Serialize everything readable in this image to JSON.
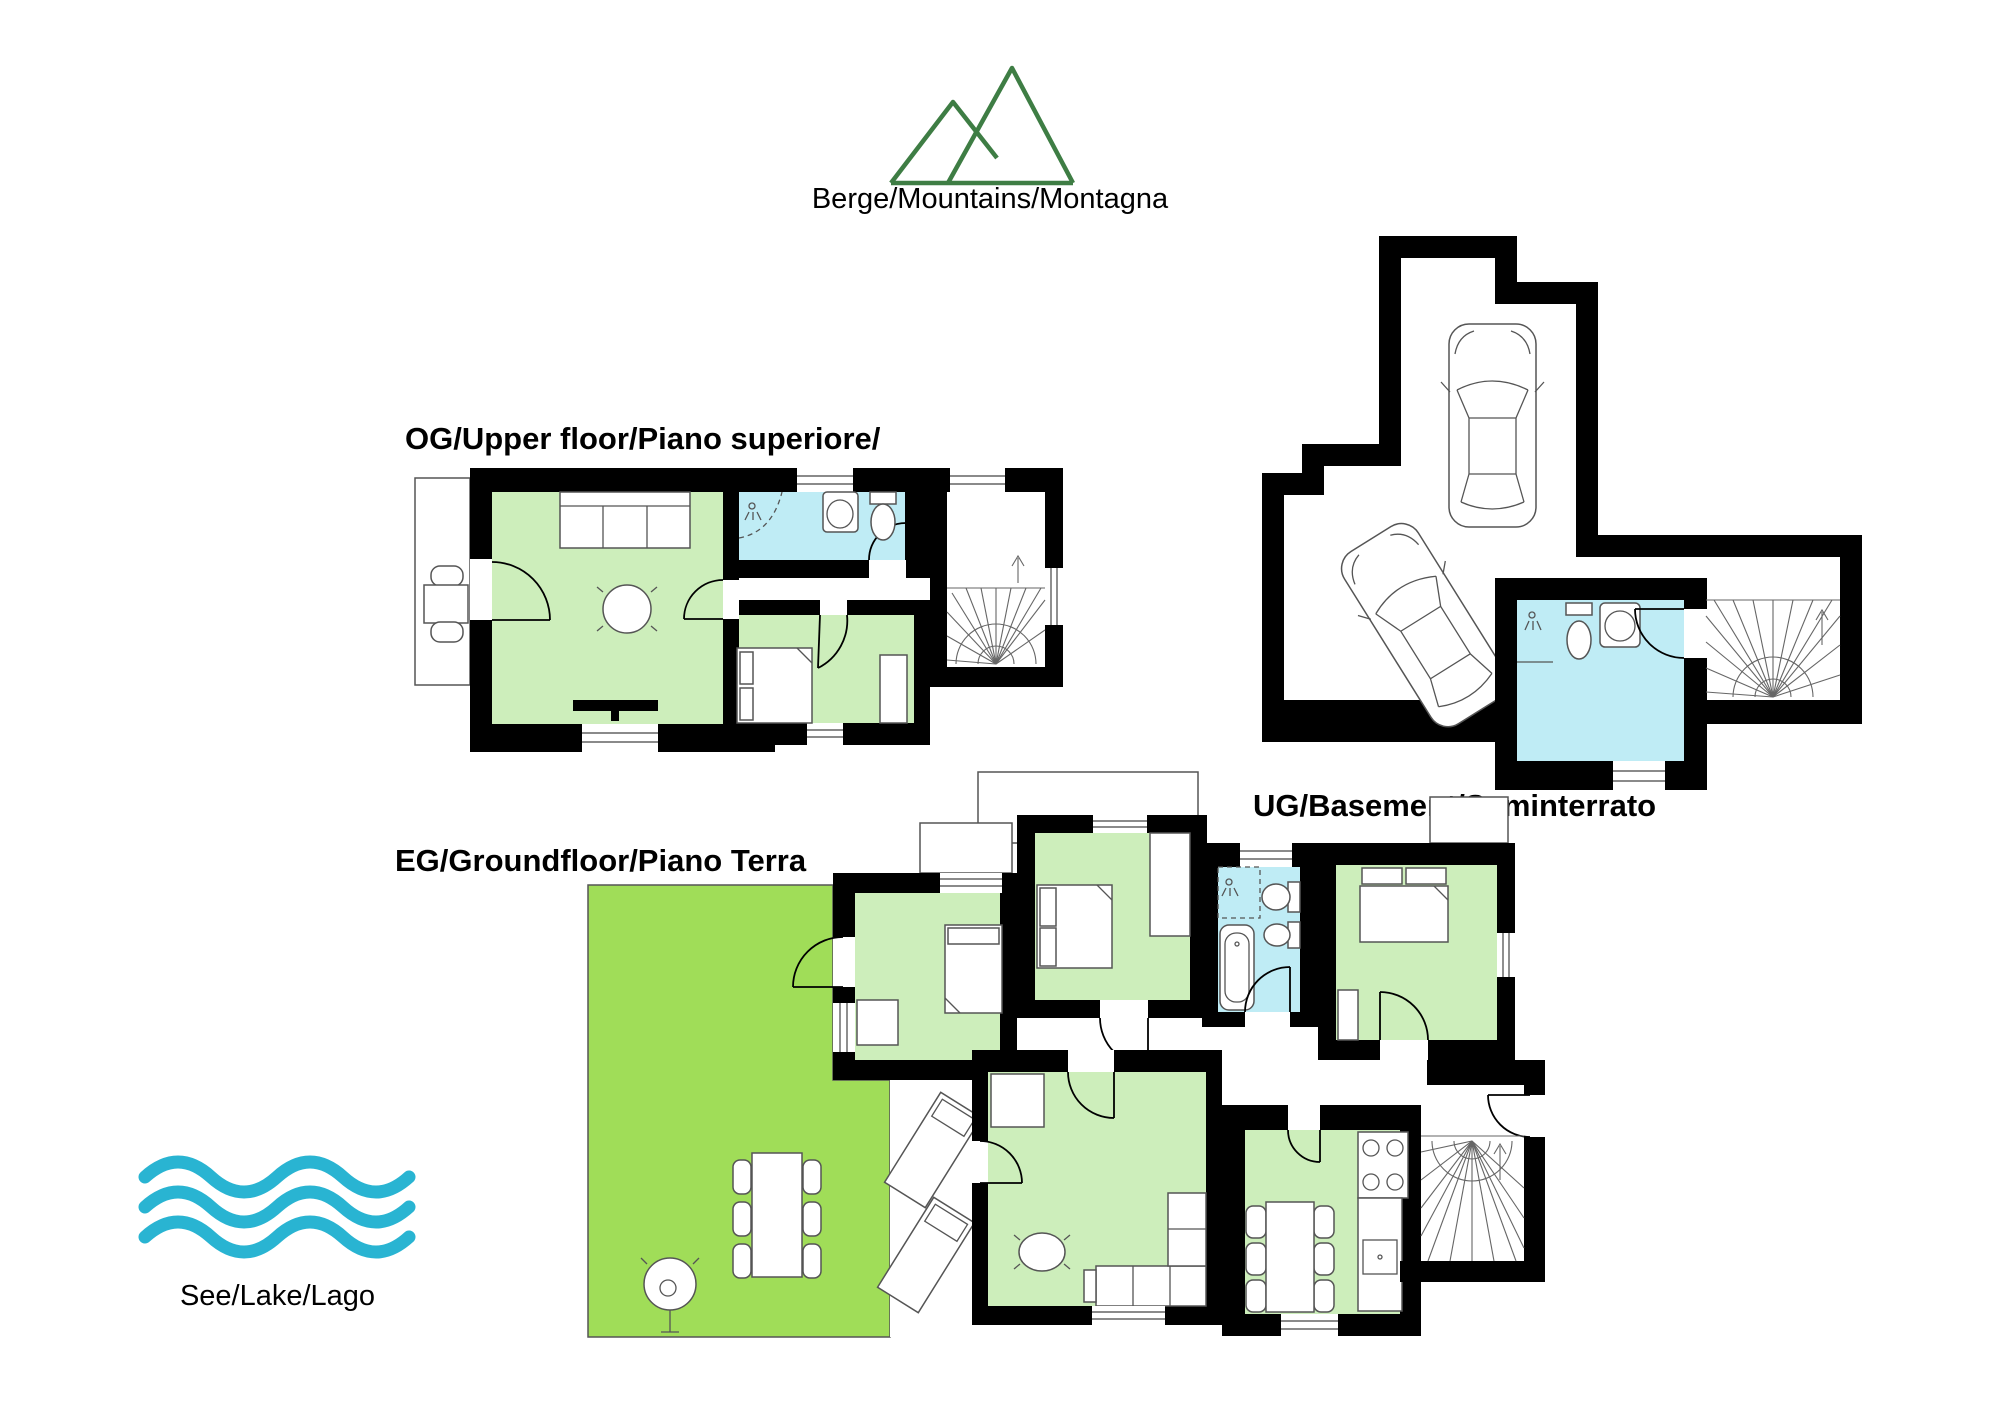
{
  "page": {
    "background": "#ffffff"
  },
  "icons": {
    "mountains": {
      "name": "mountains-icon",
      "shape": "two-peak-mountain-outline",
      "label": "Berge/Mountains/Montagna",
      "color": "#3e7d44"
    },
    "lake": {
      "name": "waves-icon",
      "shape": "three-wavy-lines",
      "label": "See/Lake/Lago",
      "color": "#29b4d2"
    },
    "car": {
      "name": "car-icon",
      "shape": "car-top-view-outline"
    },
    "stairs": {
      "name": "stairs-icon",
      "shape": "winder-staircase-fan"
    }
  },
  "floors": {
    "og": {
      "label": "OG/Upper floor/Piano superiore/"
    },
    "ug": {
      "label": "UG/Basement/Seminterrato"
    },
    "eg": {
      "label": "EG/Groundfloor/Piano Terra"
    }
  },
  "colors": {
    "wall": "#000000",
    "room": "#cdeebb",
    "bath": "#bfecf5",
    "terrace": "#a0dd58",
    "mountain": "#3e7d44",
    "lake": "#29b4d2",
    "outline": "#555555"
  }
}
